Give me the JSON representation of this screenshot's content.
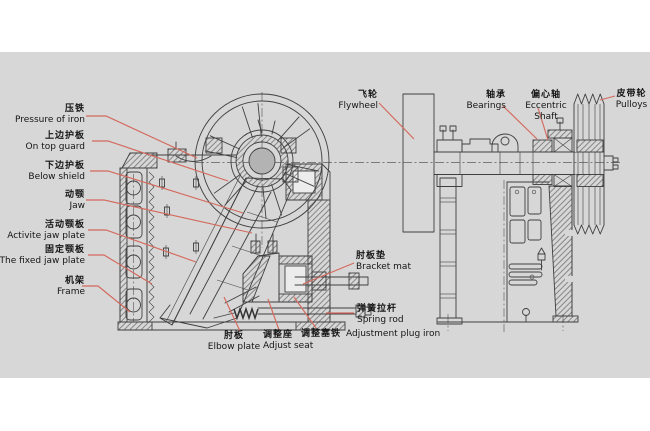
{
  "colors": {
    "background": "#ffffff",
    "panel": "#d7d7d7",
    "line": "#3f3f3f",
    "leader": "#d4695c",
    "text": "#151515"
  },
  "labels": {
    "pressure_of_iron": {
      "zh": "压铁",
      "en": "Pressure of iron"
    },
    "on_top_guard": {
      "zh": "上边护板",
      "en": "On top guard"
    },
    "below_shield": {
      "zh": "下边护板",
      "en": "Below shield"
    },
    "jaw": {
      "zh": "动颚",
      "en": "Jaw"
    },
    "active_jaw_plate": {
      "zh": "活动颚板",
      "en": "Activite jaw plate"
    },
    "fixed_jaw_plate": {
      "zh": "固定颚板",
      "en": "The fixed jaw plate"
    },
    "frame": {
      "zh": "机架",
      "en": "Frame"
    },
    "flywheel": {
      "zh": "飞轮",
      "en": "Flywheel"
    },
    "bearings": {
      "zh": "轴承",
      "en": "Bearings"
    },
    "eccentric_shaft": {
      "zh": "偏心轴",
      "en": "Eccentric Shaft"
    },
    "pulleys": {
      "zh": "皮带轮",
      "en": "Pulloys"
    },
    "bracket_mat": {
      "zh": "肘板垫",
      "en": "Bracket mat"
    },
    "spring_rod": {
      "zh": "弹簧拉杆",
      "en": "Spring rod"
    },
    "elbow_plate": {
      "zh": "肘板",
      "en": "Elbow plate"
    },
    "adjust_seat": {
      "zh": "调整座",
      "en": "Adjust seat"
    },
    "adjustment_plug_iron": {
      "zh": "调整塞铁",
      "en": "Adjustment plug iron"
    }
  }
}
